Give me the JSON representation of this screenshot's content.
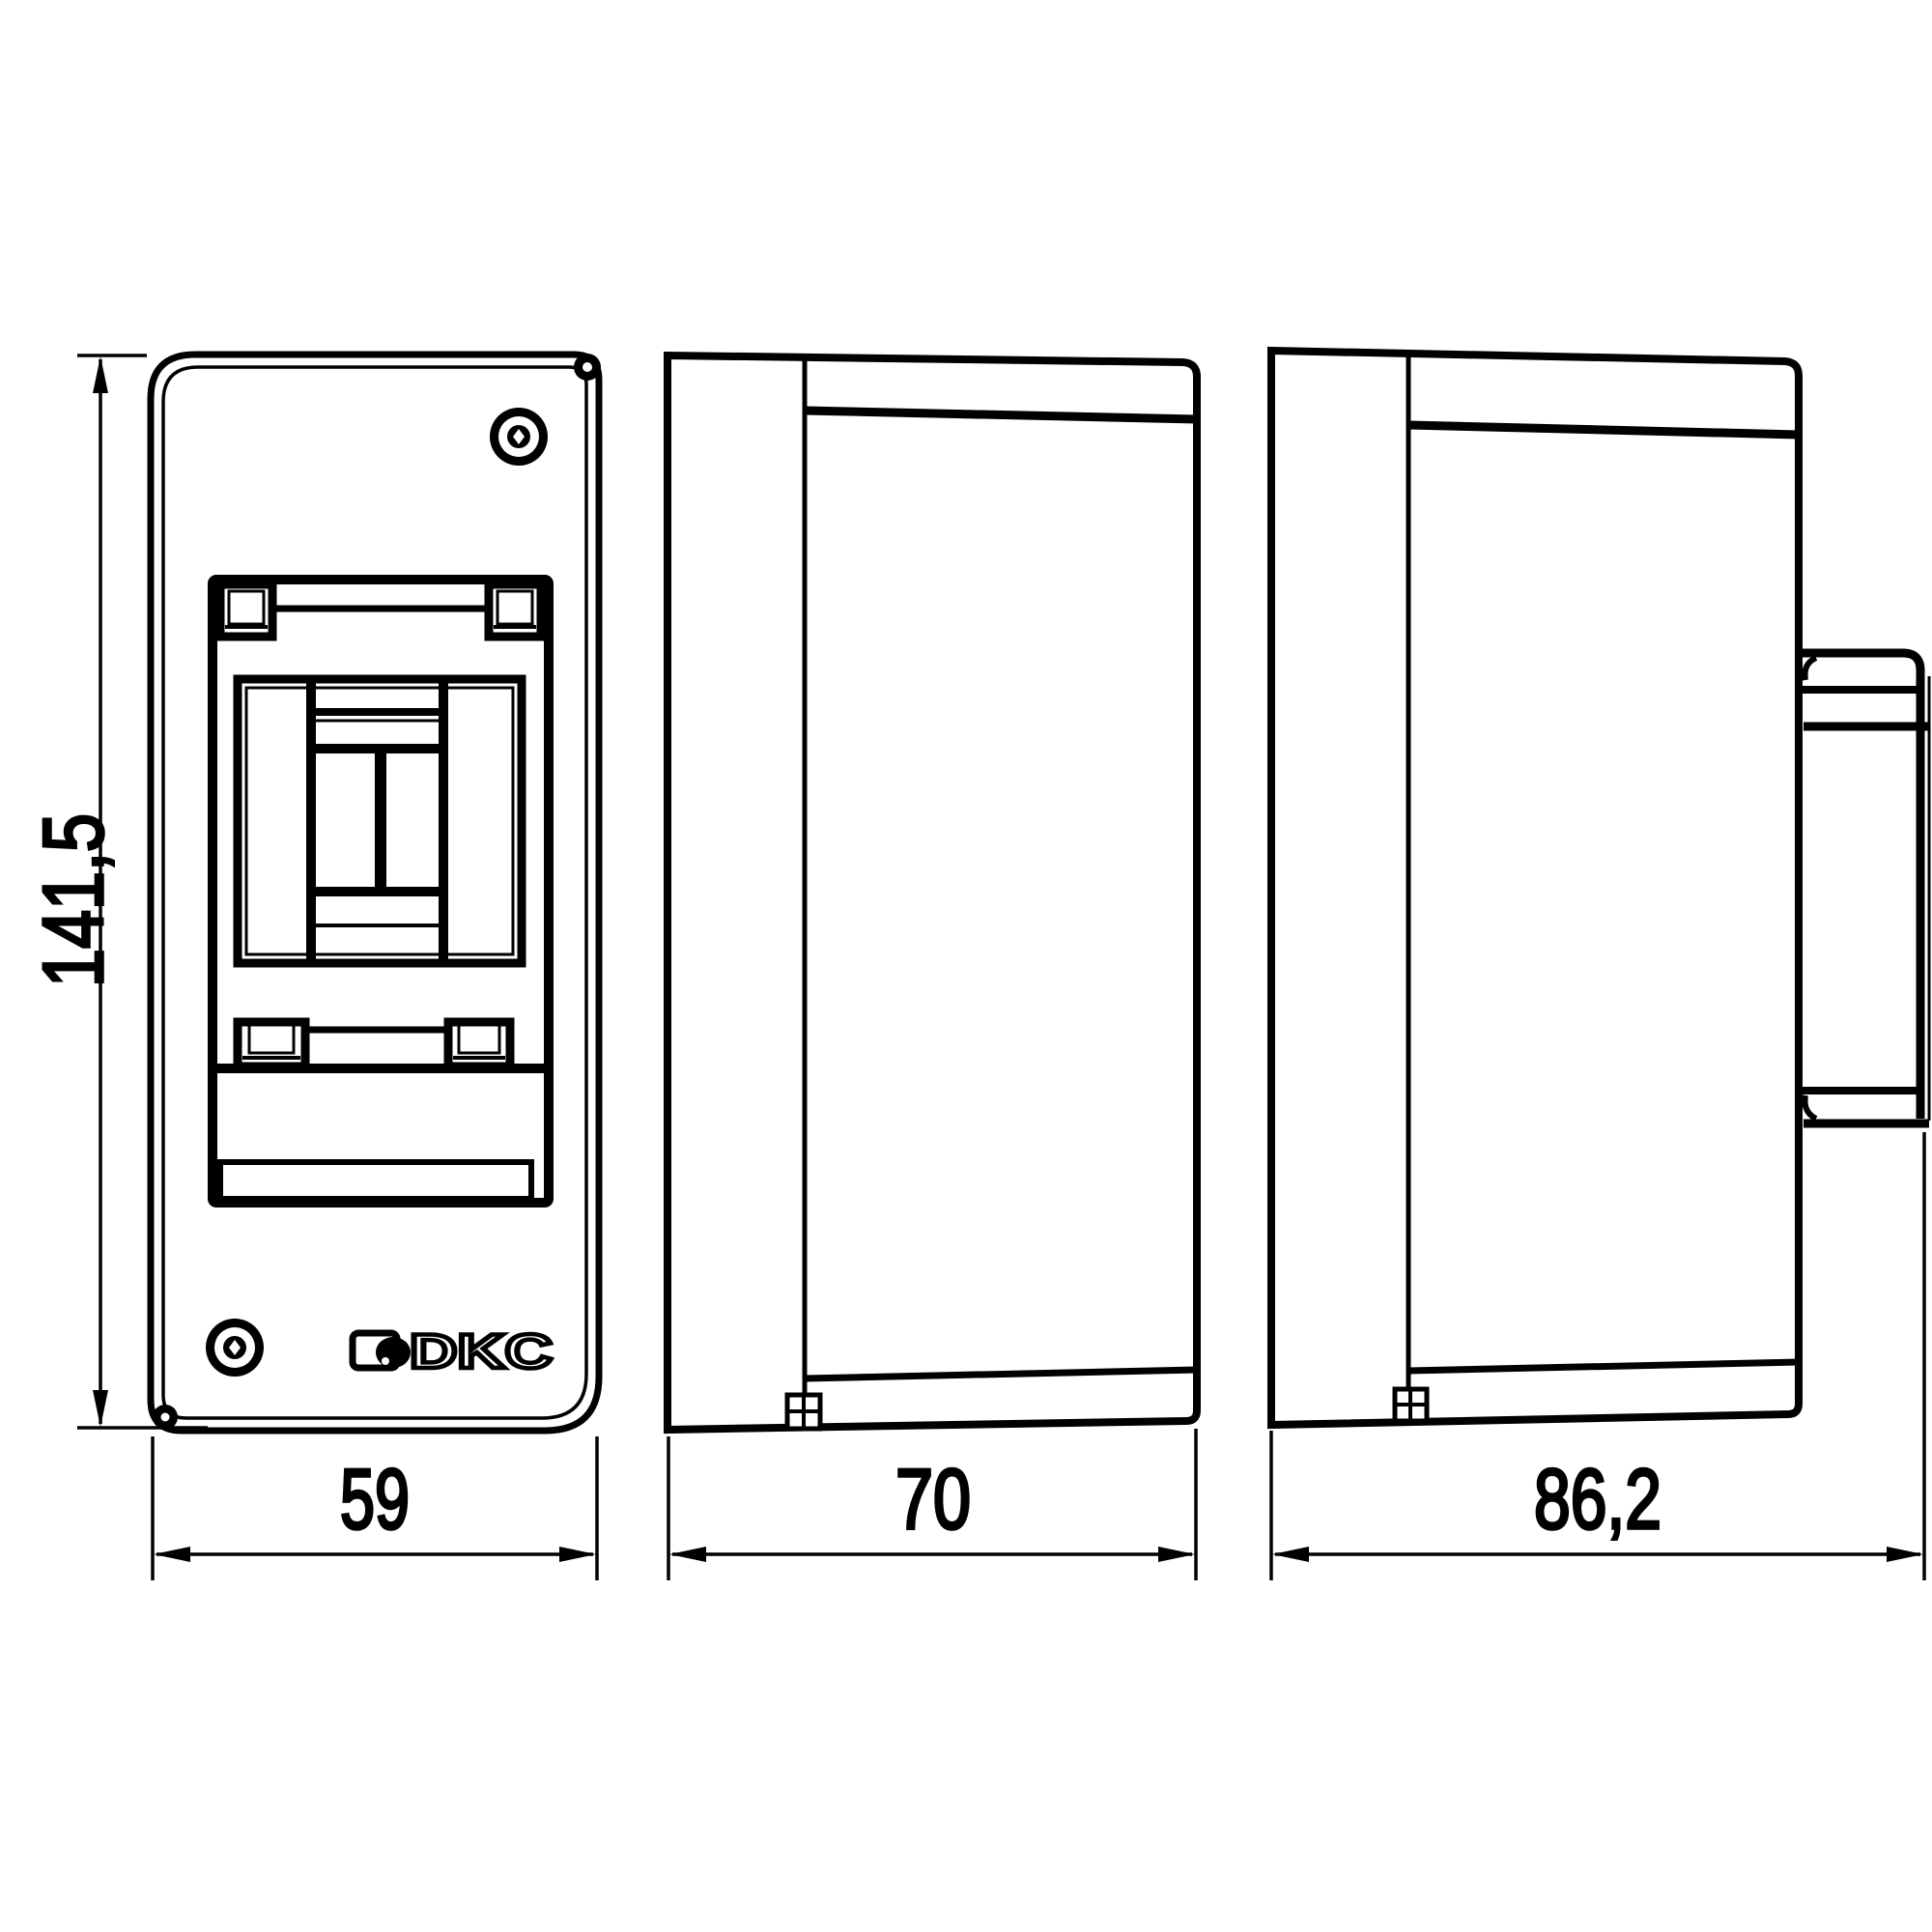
{
  "drawing": {
    "background_color": "#ffffff",
    "line_color": "#000000",
    "logo_text": "DKC",
    "dimension_labels": {
      "overall_height_mm": "141,5",
      "front_width_mm": "59",
      "body_depth_mm": "70",
      "overall_depth_mm": "86,2"
    }
  }
}
